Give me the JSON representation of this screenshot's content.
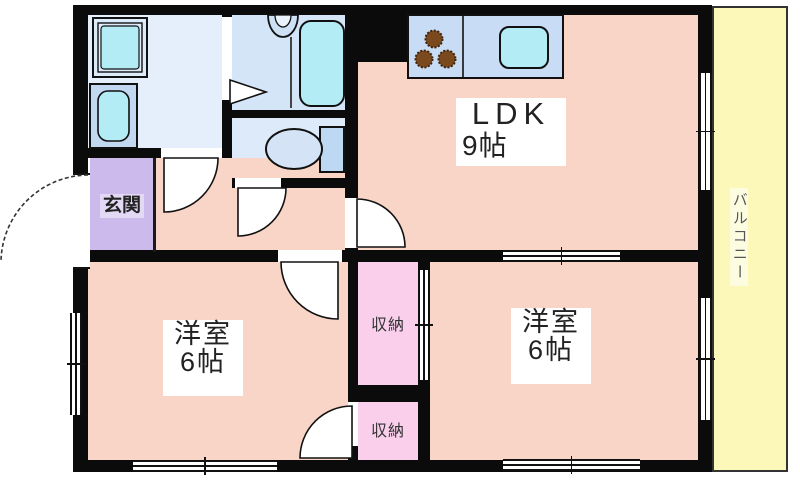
{
  "floor_plan": {
    "type": "apartment-room-layout",
    "rooms": {
      "ldk": {
        "name": "LDK",
        "size": "9帖"
      },
      "western_room_left": {
        "name": "洋室",
        "size": "6帖"
      },
      "western_room_right": {
        "name": "洋室",
        "size": "6帖"
      },
      "entrance": {
        "name": "玄関"
      },
      "closet_upper": {
        "name": "収納"
      },
      "closet_lower": {
        "name": "収納"
      },
      "balcony": {
        "name": "バルコニー"
      },
      "washroom": {
        "name": ""
      },
      "bathroom": {
        "name": ""
      },
      "toilet": {
        "name": ""
      }
    },
    "fixtures": [
      "washing-machine-pan",
      "wash-basin",
      "bathtub",
      "bath-faucet",
      "toilet",
      "kitchen-stove-3-burners",
      "kitchen-sink"
    ],
    "colors": {
      "wall": "#0b0b0b",
      "floor_pink": "#f8d5c6",
      "entrance_purple": "#ccbaec",
      "closet_pink": "#f9cfec",
      "washroom_blue": "#e4effb",
      "bath_blue": "#d3e5f7",
      "toilet_blue": "#dceafa",
      "kitchen_counter_blue": "#c8dcf5",
      "fixture_cyan": "#b3ecf5",
      "balcony_yellow": "#fbf8ba",
      "label_background": "#ffffff"
    }
  }
}
